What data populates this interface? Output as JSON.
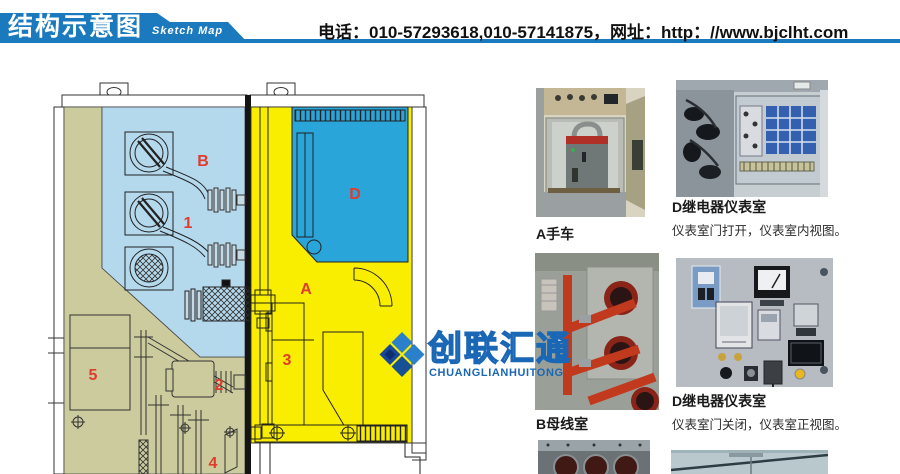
{
  "header": {
    "title_cn": "结构示意图",
    "title_en": "Sketch Map",
    "contact": "电话：010-57293618,010-57141875，网址：http：//www.bjclht.com",
    "banner_color": "#1b79bd"
  },
  "watermark": {
    "name_cn": "创联汇通",
    "name_en": "CHUANGLIANHUITONG",
    "color": "#1a67b6"
  },
  "diagram": {
    "description": "switchgear-structure-cross-section",
    "label_color": "#e03c2e",
    "region_colors": {
      "busbar_chamber_light_blue": "#b4d8ec",
      "cable_chamber_olive": "#cbcb9e",
      "breaker_chamber_yellow": "#f9ed00",
      "instrument_chamber_blue": "#29a5da"
    },
    "labels": [
      {
        "text": "B"
      },
      {
        "text": "1"
      },
      {
        "text": "D"
      },
      {
        "text": "A"
      },
      {
        "text": "3"
      },
      {
        "text": "2"
      },
      {
        "text": "5"
      },
      {
        "text": "4"
      }
    ]
  },
  "photos": [
    {
      "caption": "A手车"
    },
    {
      "title": "D继电器仪表室",
      "caption": "仪表室门打开，仪表室内视图。"
    },
    {
      "caption": "B母线室"
    },
    {
      "title": "D继电器仪表室",
      "caption": "仪表室门关闭，仪表室正视图。"
    }
  ]
}
